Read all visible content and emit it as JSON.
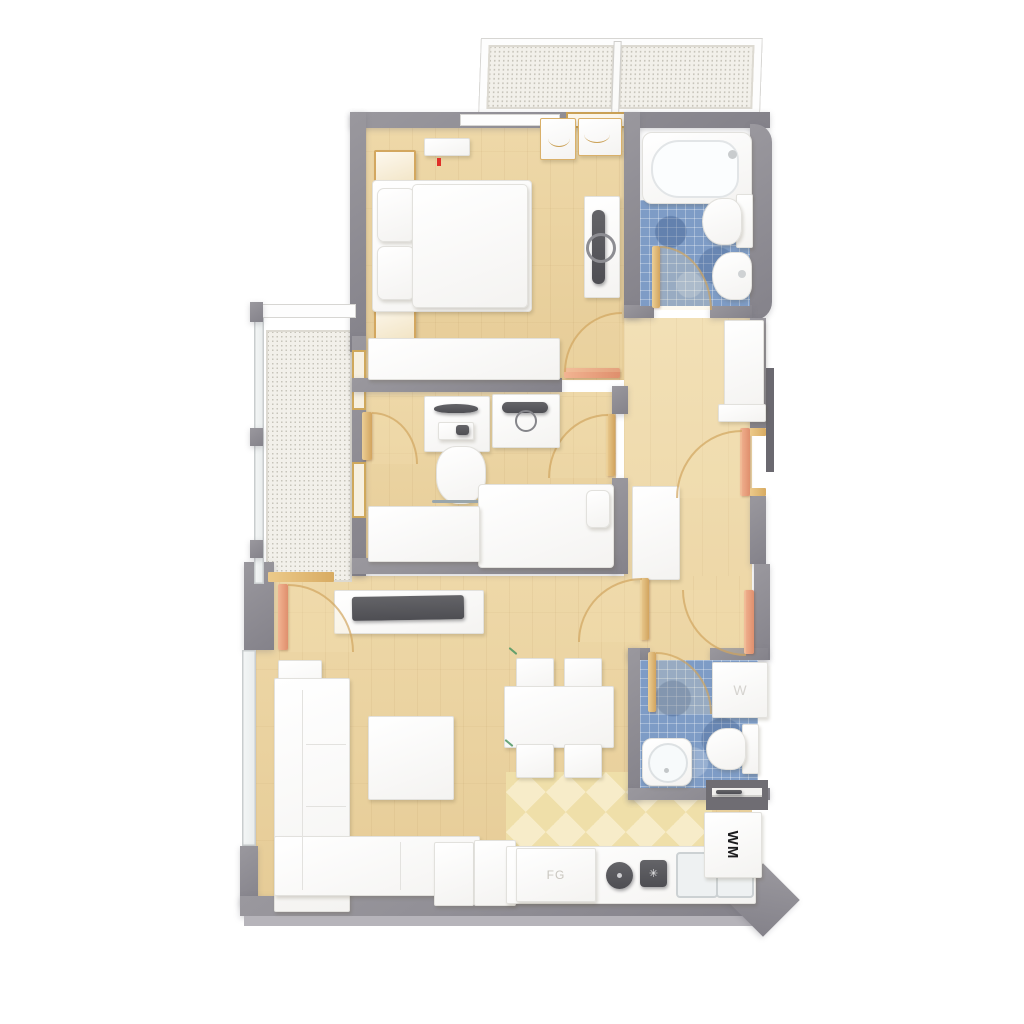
{
  "meta": {
    "title": "3D apartment floor plan, top-down view",
    "canvas": "1024x1024"
  },
  "palette": {
    "background": "#ffffff",
    "wall_grey": "#8e8c92",
    "wall_face_light": "#b6b4ba",
    "wood_floor": "#ead2a0",
    "kitchen_checker": "#f1e0aa",
    "bathroom_tile_blue": "#7e9cc6",
    "balcony_mesh": "#f0eee8",
    "door_salmon": "#e89a74",
    "door_gold": "#d9ae64",
    "furniture_white": "#ffffff",
    "tv_dark_grey": "#55555a",
    "ac_indicator_red": "#e03028",
    "plant_green": "#4d9663"
  },
  "labels": {
    "washing_machine": "WM",
    "fridge_unit": "FG",
    "washer_box": "W"
  },
  "rooms": [
    {
      "name": "balcony-top",
      "floor": "metal-mesh",
      "items": [
        "mesh-deck-left",
        "mesh-deck-right",
        "railing-frame"
      ]
    },
    {
      "name": "master-bedroom",
      "floor": "wood",
      "items": [
        "double-bed",
        "pillow",
        "pillow",
        "nightstand",
        "nightstand",
        "ac-unit",
        "long-wardrobe",
        "tv-sideboard",
        "tv",
        "coat-rack",
        "door-to-hallway"
      ]
    },
    {
      "name": "bathroom-1",
      "floor": "blue-mosaic-tile",
      "items": [
        "bathtub",
        "toilet",
        "bidet",
        "door"
      ]
    },
    {
      "name": "hallway",
      "floor": "wood",
      "items": [
        "entrance-door",
        "tall-cabinet",
        "cabinet-base",
        "side-cabinet",
        "door-to-living",
        "door-to-office"
      ]
    },
    {
      "name": "office-bedroom",
      "floor": "wood",
      "items": [
        "desk",
        "monitor",
        "keyboard",
        "office-chair",
        "sideboard",
        "media-player",
        "single-bed",
        "wardrobe",
        "balcony-door"
      ]
    },
    {
      "name": "balcony-left",
      "floor": "metal-mesh",
      "items": [
        "glass-railing",
        "railing-posts",
        "door-to-living"
      ]
    },
    {
      "name": "living-room",
      "floor": "wood",
      "items": [
        "corner-sofa",
        "side-table",
        "coffee-table",
        "tv-lowboard",
        "tv",
        "dining-table",
        "chair",
        "chair",
        "chair",
        "chair",
        "plant",
        "plant"
      ]
    },
    {
      "name": "kitchen",
      "floor": "checker-tile",
      "items": [
        "fridge-unit",
        "cooktop-round-burner",
        "cooktop-square-burner",
        "double-sink",
        "counter",
        "cabinet",
        "cabinet",
        "washing-machine",
        "shelf-niche"
      ]
    },
    {
      "name": "bathroom-2",
      "floor": "blue-mosaic-tile",
      "items": [
        "washer-box",
        "toilet",
        "round-sink",
        "door"
      ]
    }
  ]
}
